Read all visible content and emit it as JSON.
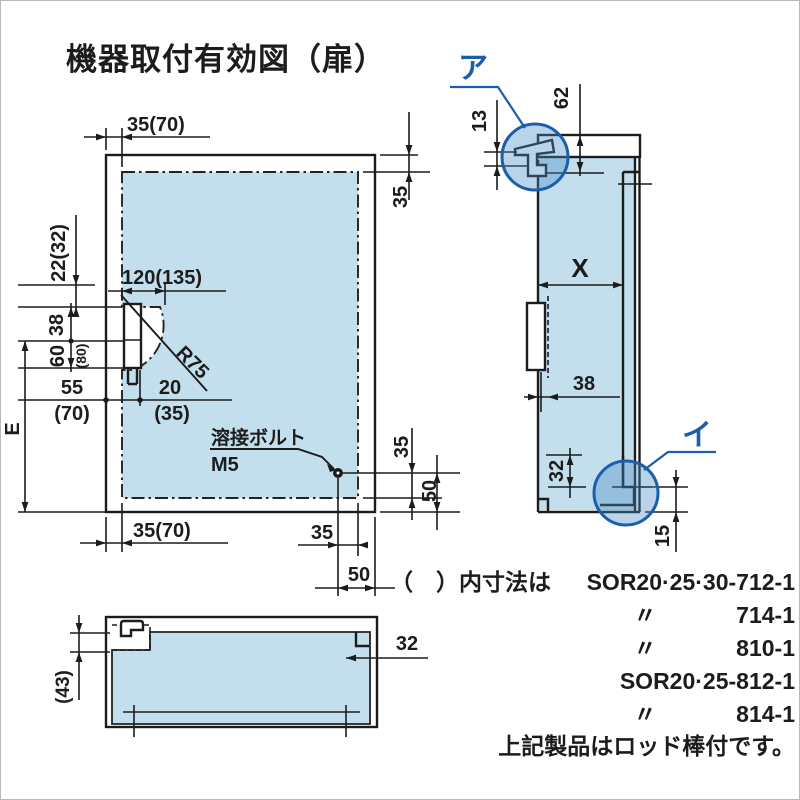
{
  "title": "機器取付有効図（扉）",
  "colors": {
    "panel": "#c3dfee",
    "accent": "#1b5ea9",
    "line": "#1c1c1c"
  },
  "front": {
    "dim_top": "35(70)",
    "dim_top_right": "35",
    "dim_left_offset": "22(32)",
    "dim_38": "38",
    "dim_60": "60",
    "dim_80": "(80)",
    "dim_55": "55",
    "dim_55_alt": "(70)",
    "dim_20": "20",
    "dim_20_alt": "(35)",
    "dim_width": "120(135)",
    "dim_radius": "R75",
    "dim_e": "E",
    "bolt_label": "溶接ボルト",
    "bolt_size": "M5",
    "dim_right_35": "35",
    "dim_right_50": "50",
    "dim_bottom_35": "35",
    "dim_bottom_50": "50",
    "dim_bottom_left": "35(70)"
  },
  "side": {
    "callout_a": "ア",
    "callout_b": "イ",
    "dim_13": "13",
    "dim_62": "62",
    "dim_x": "X",
    "dim_38": "38",
    "dim_32": "32",
    "dim_15": "15"
  },
  "bottom": {
    "dim_43": "(43)",
    "dim_32": "32"
  },
  "notes": {
    "intro": "（　）内寸法は",
    "model_1": "SOR20·25·30-712-1",
    "ditto_2": "〃",
    "num_2": "714-1",
    "ditto_3": "〃",
    "num_3": "810-1",
    "model_4": "SOR20·25-812-1",
    "ditto_5": "〃",
    "num_5": "814-1",
    "footer": "上記製品はロッド棒付です。"
  }
}
